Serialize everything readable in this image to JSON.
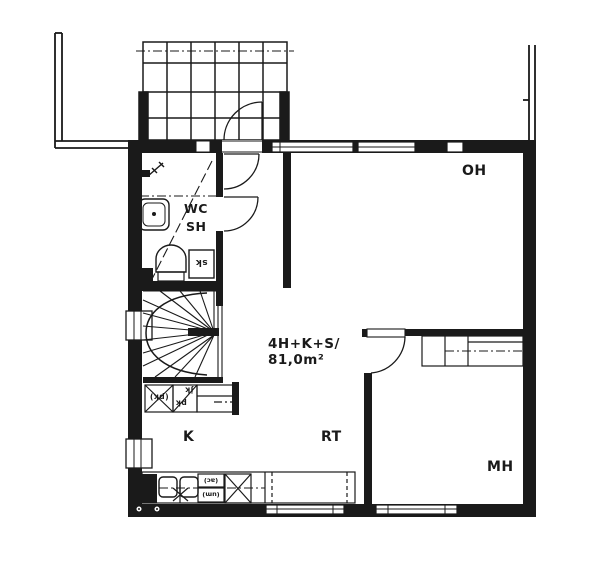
{
  "colors": {
    "ink": "#1a1a1a",
    "paper": "#ffffff"
  },
  "apartment": {
    "type": "4H+K+S/",
    "area": "81,0m²"
  },
  "rooms": {
    "oh": "OH",
    "k": "K",
    "rt": "RT",
    "mh": "MH",
    "wc": "WC",
    "sh": "SH"
  },
  "fixtures": {
    "sk": "sk",
    "pk_reserved": "(pk)",
    "pk": "pk",
    "jk": "jk",
    "ac": "(ac)",
    "um": "(um)"
  }
}
